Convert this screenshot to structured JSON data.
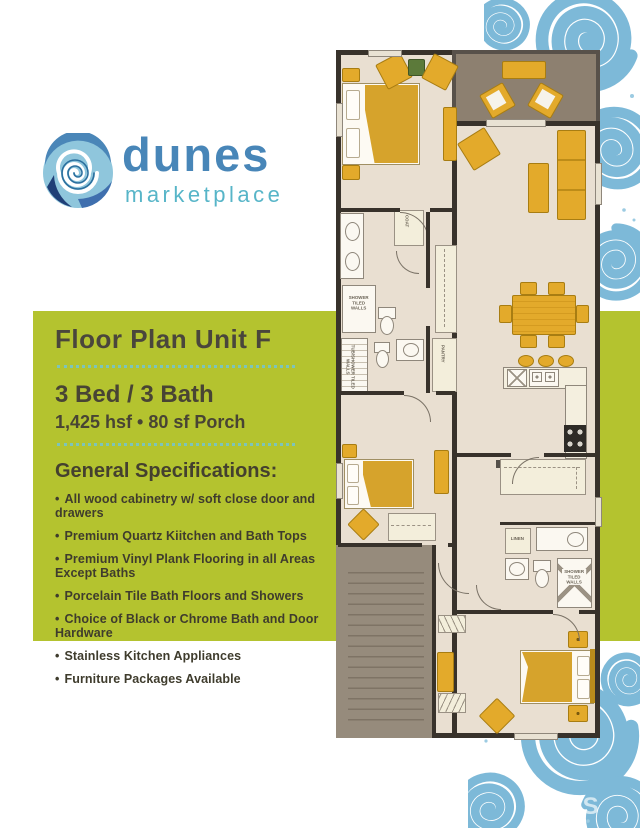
{
  "logo": {
    "name": "dunes",
    "tagline": "marketplace"
  },
  "panel": {
    "title": "Floor Plan Unit F",
    "beds": "3 Bed / 3 Bath",
    "area": "1,425 hsf • 80 sf Porch",
    "specs_heading": "General Specifications:",
    "bullet": "•",
    "specs": [
      "All wood cabinetry w/ soft close door and drawers",
      "Premium Quartz Kiitchen and Bath Tops",
      "Premium Vinyl Plank Flooring in all Areas Except Baths",
      "Porcelain Tile Bath Floors and Showers",
      "Choice of Black or Chrome Bath and Door Hardware",
      "Stainless Kitchen Appliances",
      "Furniture Packages Available"
    ]
  },
  "floorplan": {
    "labels": {
      "coat": "COAT",
      "pantry": "PANTRY",
      "linen": "LINEN",
      "shower_1": "SHOWER TILED WALLS",
      "tub_shower": "TUB/SHOWER TILED WALLS",
      "shower_2": "SHOWER TILED WALLS"
    }
  },
  "watermark": "MLS",
  "colors": {
    "accent_green": "#b4c32f",
    "logo_blue": "#4886b8",
    "logo_teal": "#57b5c8",
    "swirl_blue": "#7db9d8",
    "wall_dark": "#38322b",
    "furniture_gold": "#e3aa2b",
    "floor_beige": "#e9dfd1",
    "porch_gray": "#8d8070"
  }
}
